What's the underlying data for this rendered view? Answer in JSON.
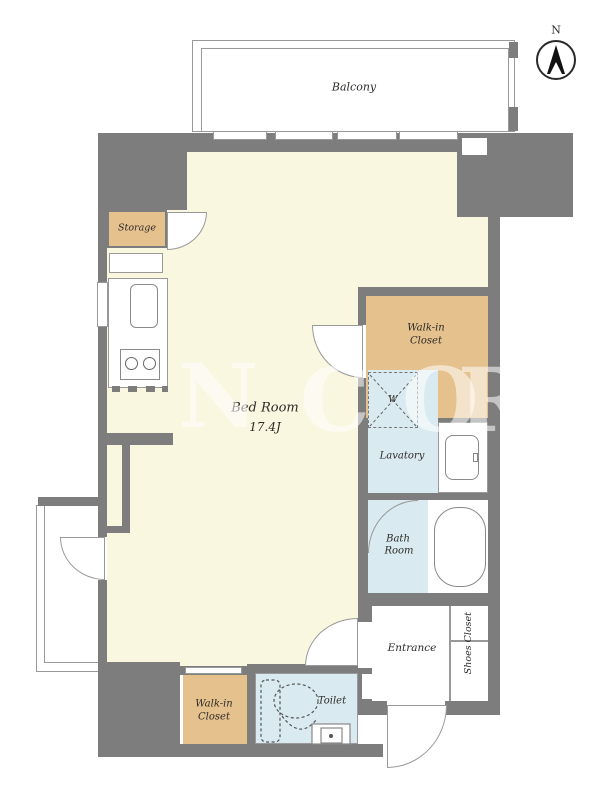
{
  "colors": {
    "wall": "#7d7d7d",
    "floor_cream": "#faf7e0",
    "closet_tan": "#e4c18d",
    "wet_area_blue": "#d9eaf0",
    "line": "#999999",
    "label_text": "#2e2b28"
  },
  "labels": {
    "balcony": "Balcony",
    "bedroom_name": "Bed Room",
    "bedroom_size": "17.4J",
    "storage": "Storage",
    "walk_in_closet_line1": "Walk-in",
    "walk_in_closet_line2": "Closet",
    "lavatory": "Lavatory",
    "bath_line1": "Bath",
    "bath_line2": "Room",
    "toilet": "Toilet",
    "entrance": "Entrance",
    "shoes_closet": "Shoes Closet",
    "washer": "W",
    "compass_north": "N"
  },
  "watermark": {
    "letters": [
      "N",
      "C",
      "O",
      "R"
    ]
  }
}
